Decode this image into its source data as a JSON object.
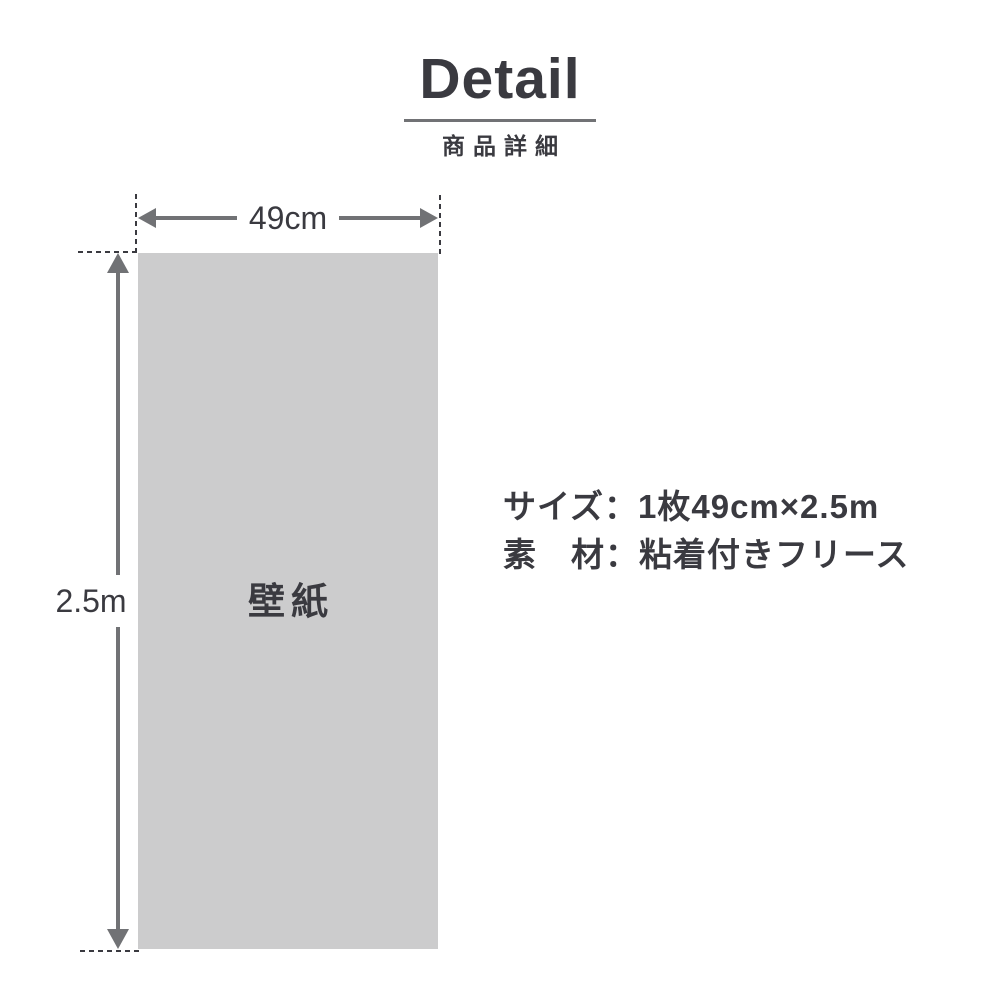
{
  "header": {
    "title": "Detail",
    "subtitle": "商品詳細"
  },
  "diagram": {
    "panel_label": "壁紙",
    "width_label": "49cm",
    "height_label": "2.5m"
  },
  "specs": [
    {
      "label": "サイズ",
      "separator": "：",
      "value": "1枚49cm×2.5m"
    },
    {
      "label": "素　材",
      "separator": "：",
      "value": "粘着付きフリース"
    }
  ],
  "colors": {
    "text": "#3a3a40",
    "line": "#717275",
    "panel": "#cccccd",
    "background": "#ffffff"
  }
}
